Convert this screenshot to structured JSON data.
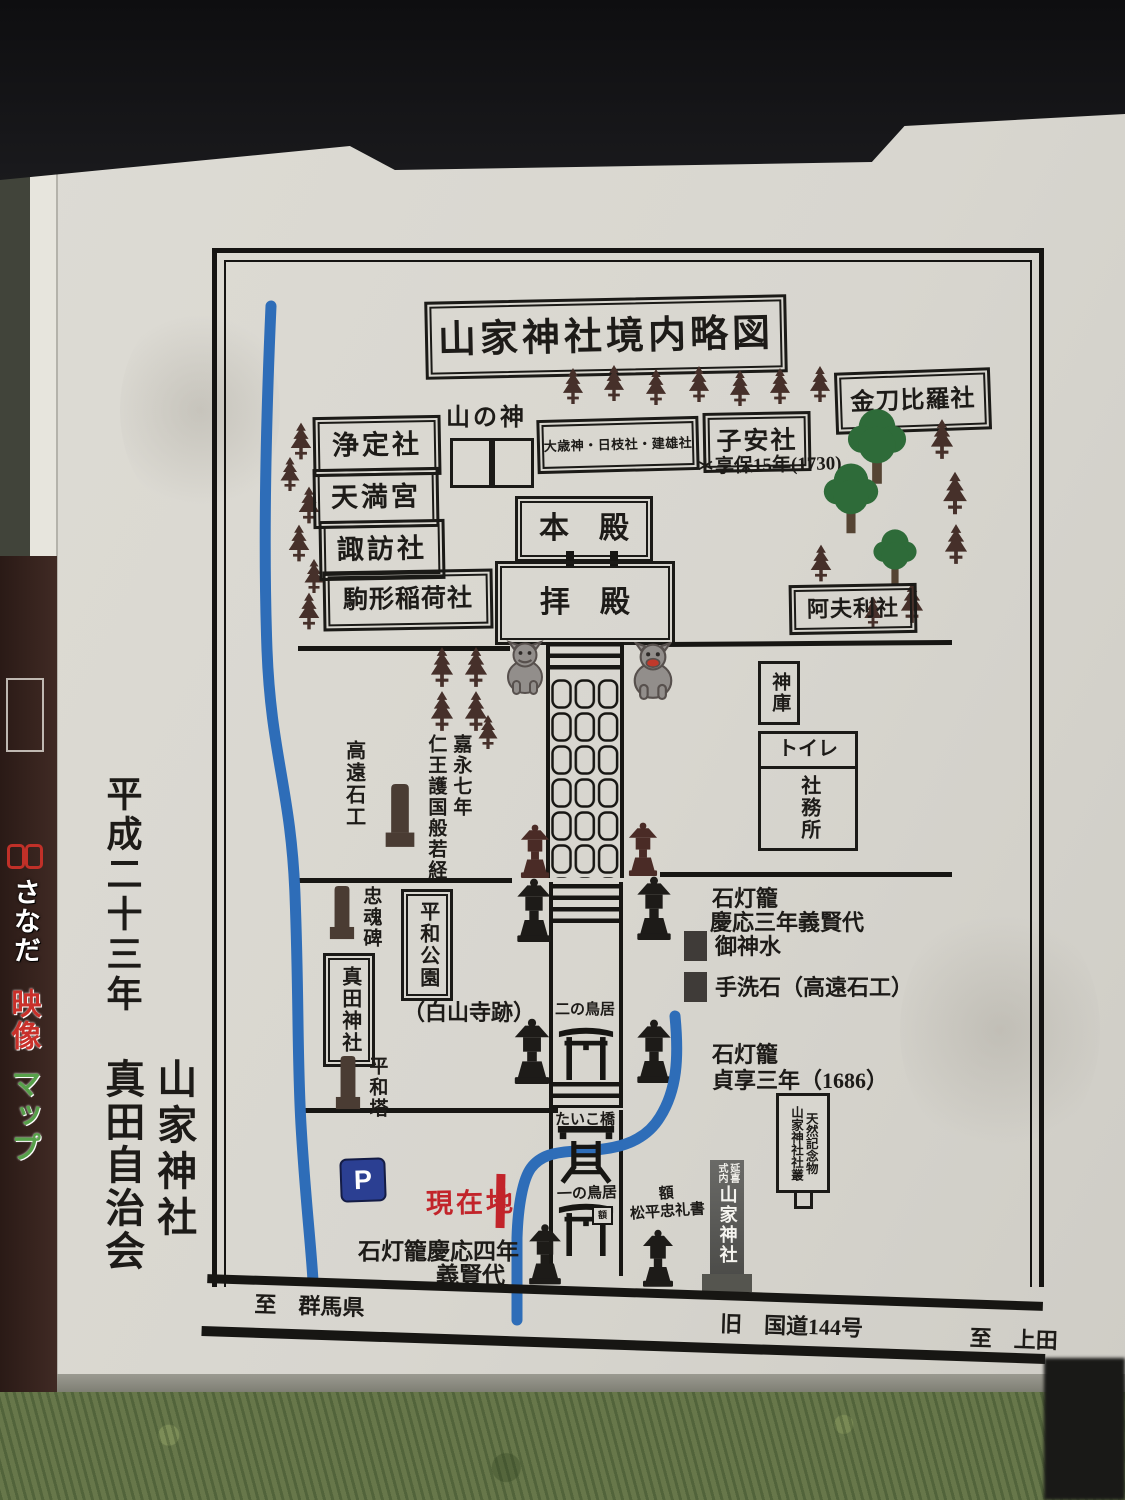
{
  "side_sign": {
    "line1": "さなだ",
    "line2": "映像",
    "line3": "マップ"
  },
  "board_credit": {
    "year": "平成二十三年",
    "shrine": "山家神社",
    "org": "真田自治会"
  },
  "map": {
    "title": "山家神社境内略図",
    "shrines_left": {
      "jotei": "浄定社",
      "tenmangu": "天満宮",
      "suwa": "諏訪社",
      "komagata": "駒形稲荷社"
    },
    "top": {
      "yamanokami": "山の神",
      "otoshi": "大歳神・日枝社・建雄社",
      "koyasu": "子安社",
      "koyasu_note": "＊享保15年(1730)",
      "kotohira": "金刀比羅社"
    },
    "center": {
      "honden": "本　殿",
      "haiden": "拝　殿",
      "afuri": "阿夫利社",
      "shinko": "神庫",
      "toilet": "トイレ",
      "shamusho": "社務所"
    },
    "west": {
      "takato": "高遠石工",
      "kaei": "嘉永七年",
      "nio": "仁王護国般若経",
      "chukonhi": "忠魂碑",
      "heiwa_koen": "平和公園",
      "sanada_jinja": "真田神社",
      "hakusan": "（白山寺跡）",
      "heiwato": "平和塔"
    },
    "east": {
      "ishidoro_keio3_1": "石灯籠",
      "ishidoro_keio3_2": "慶応三年義賢代",
      "goshinsui": "御神水",
      "chozu": "手洗石（高遠石工）",
      "ishidoro_jokyo_1": "石灯籠",
      "ishidoro_jokyo_2": "貞享三年（1686）",
      "tennen_r": "天然記念物",
      "tennen_l": "山家神社社叢",
      "pillar_top_l": "式内",
      "pillar_top_r": "延喜",
      "pillar_main": "山家神社"
    },
    "path": {
      "ni_no_torii": "二の鳥居",
      "taiko": "たいこ橋",
      "ichi_no_torii": "一の鳥居",
      "gaku_plaque": "額",
      "gaku_1": "額",
      "gaku_2": "松平忠礼書"
    },
    "south": {
      "parking": "P",
      "genzaichi": "現在地",
      "ishidoro_keio4_1": "石灯籠慶応四年",
      "ishidoro_keio4_2": "義賢代"
    },
    "road": {
      "to_gunma": "至　群馬県",
      "route": "旧　国道144号",
      "to_ueda": "至　上田"
    }
  },
  "colors": {
    "river": "#2e6db8",
    "accent_red": "#c2242a",
    "parking_blue": "#2b3f92",
    "board": "#d8d6cf",
    "ink": "#1d1b18"
  },
  "icons": {
    "conifer-tree": "#46302a",
    "broadleaf-tree": "#2e6b39",
    "stone-lantern": "#1d1b18",
    "wood-lantern": "#4a2b26",
    "komainu": "#928e8b",
    "monument": "#4a3c33",
    "torii": "#171613"
  }
}
